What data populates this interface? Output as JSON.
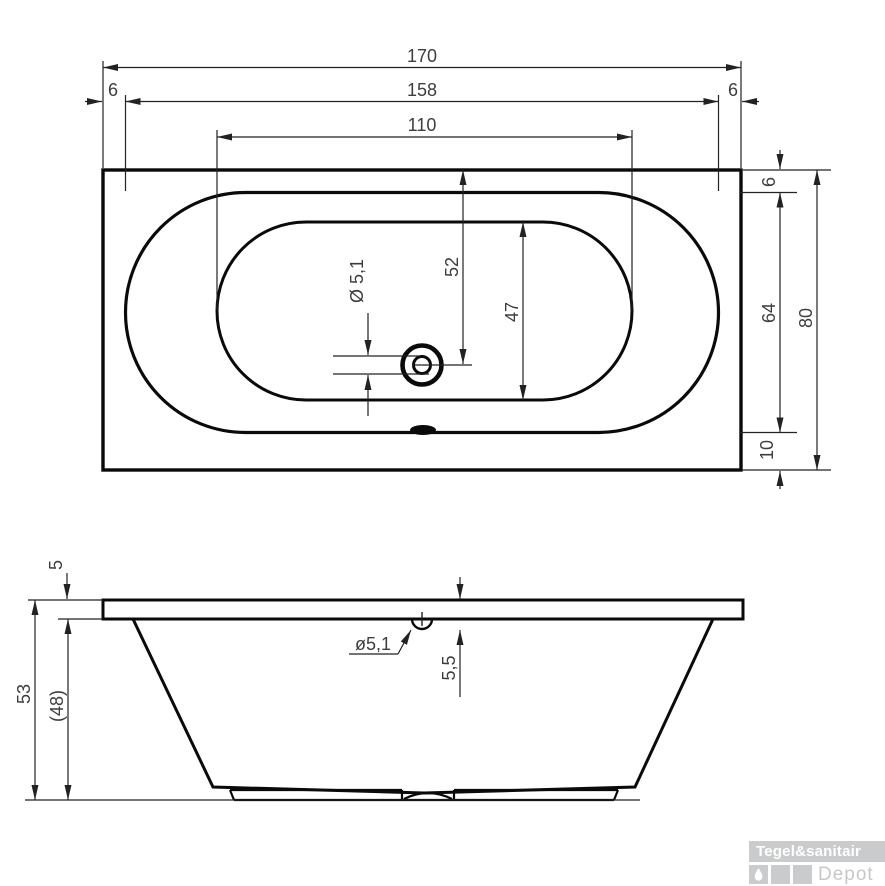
{
  "drawing": {
    "type": "bathtub technical drawing",
    "views": {
      "top": "top view",
      "front": "front elevation"
    }
  },
  "colors": {
    "line": "#0a0a0a",
    "dimension_line": "#222222",
    "dimension_text": "#3d3d3d",
    "logo_gray": "#c9cbcc",
    "logo_text_white": "#ffffff"
  },
  "top_view": {
    "length_total": "170",
    "length_rim": "158",
    "rim_edge_left": "6",
    "rim_edge_right": "6",
    "length_floor": "110",
    "rim_edge_top": "6",
    "width_rim": "64",
    "width_total": "80",
    "rim_edge_bottom": "10",
    "drain_offset_from_top": "52",
    "width_floor": "47",
    "drain_diameter": "Ø 5,1"
  },
  "front_view": {
    "rim_thickness": "5",
    "height_total": "53",
    "height_inner": "(48)",
    "overflow_diameter": "ø5,1",
    "overflow_depth": "5,5"
  },
  "logo": {
    "brand": "Tegel&sanitair",
    "subtitle": "Depot",
    "icon": "drop-icon"
  }
}
